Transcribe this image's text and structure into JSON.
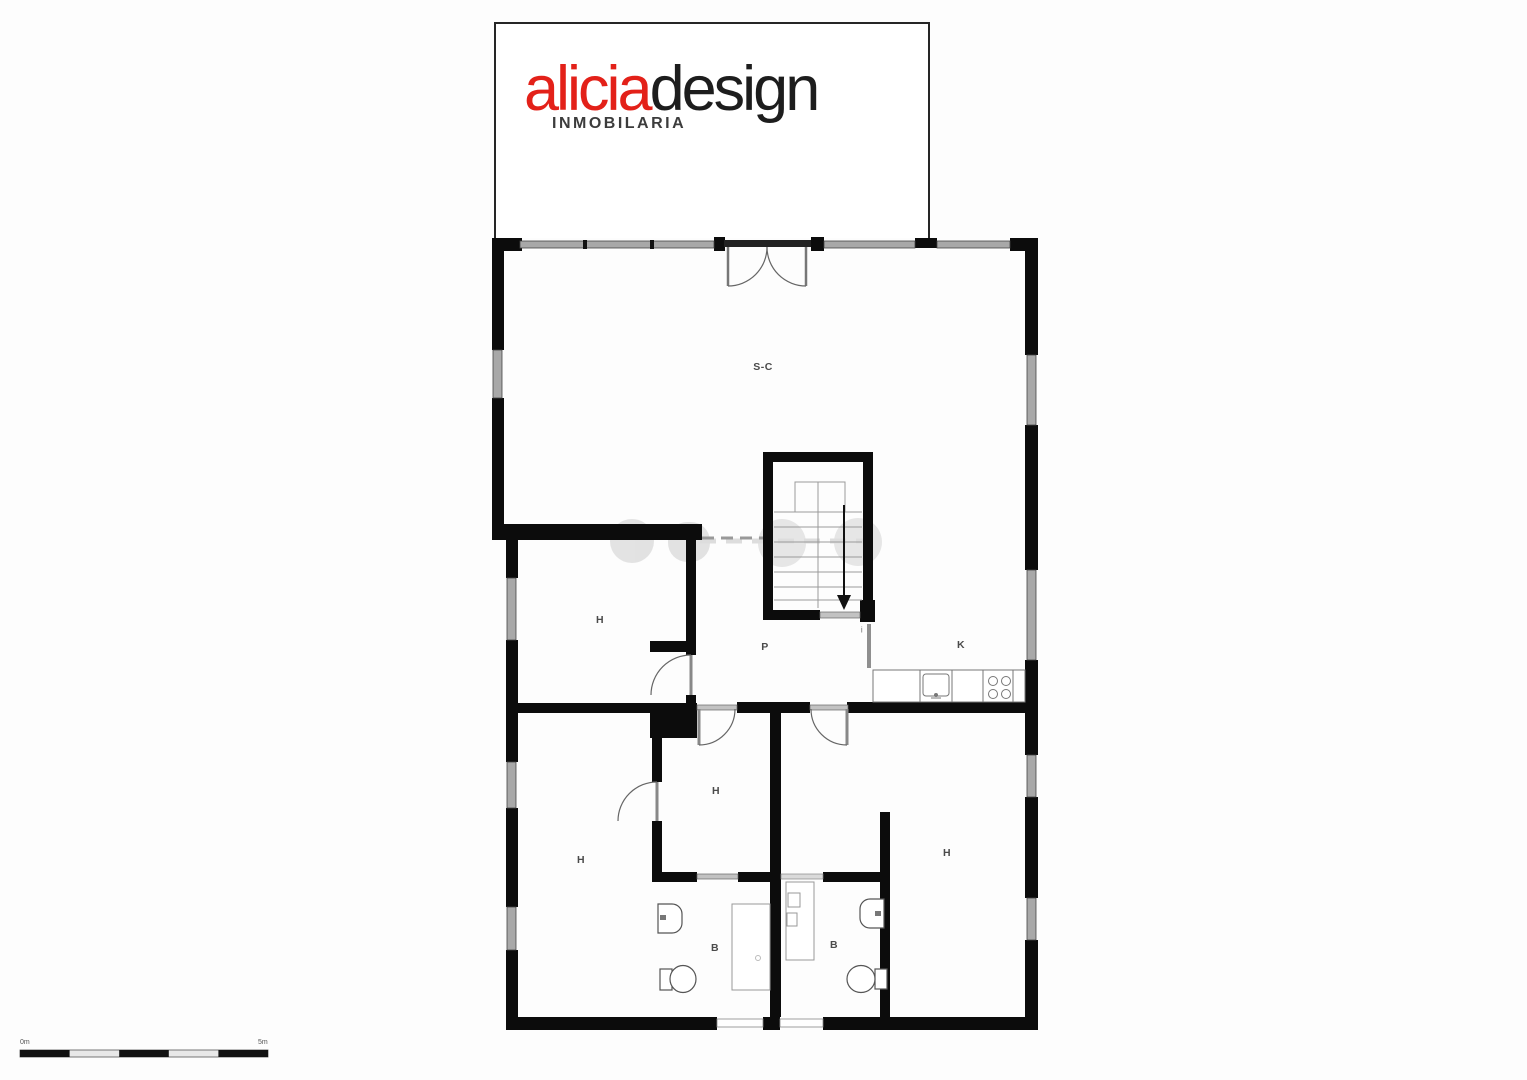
{
  "logo": {
    "brand_primary": "alicia",
    "brand_secondary": "design",
    "subtitle": "INMOBILARIA",
    "primary_color": "#e32119",
    "secondary_color": "#1d1d1d"
  },
  "floorplan": {
    "wall_color": "#0c0c0c",
    "window_color": "#a8a8a8",
    "labels": {
      "living": "S-C",
      "hall1": "H",
      "passage": "P",
      "kitchen": "K",
      "entry": "i",
      "hall2": "H",
      "bedroom_left": "H",
      "bedroom_right": "H",
      "bath1": "B",
      "bath2": "B"
    }
  },
  "scale_bar": {
    "start_label": "0m",
    "end_label": "5m"
  }
}
